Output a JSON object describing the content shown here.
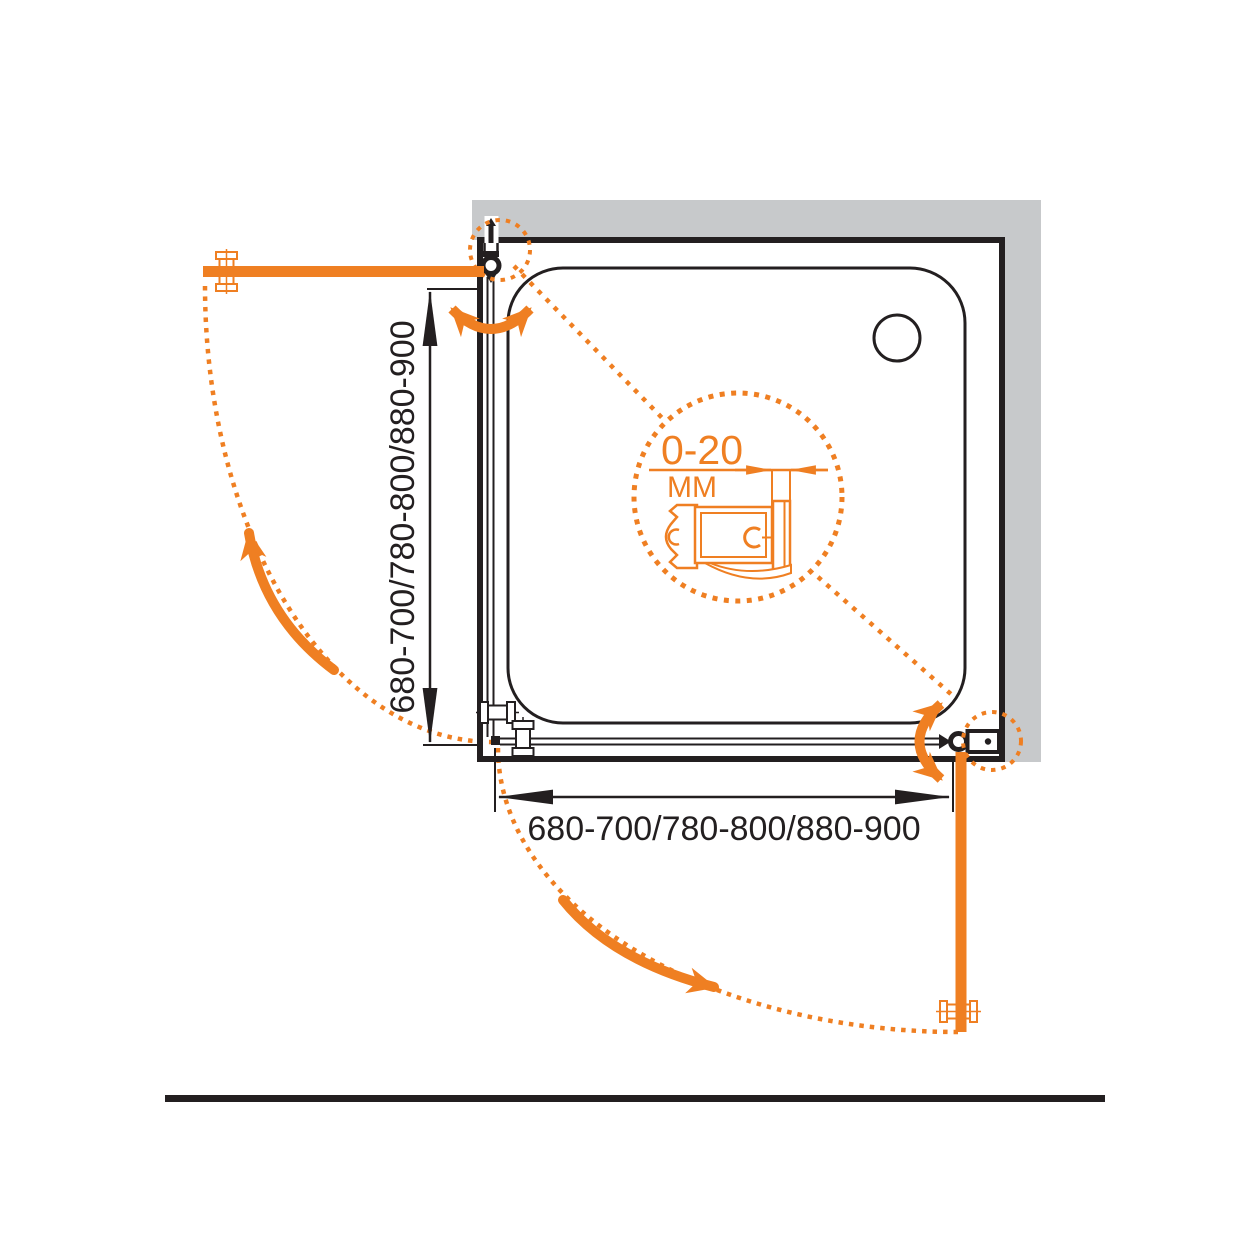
{
  "colors": {
    "accent": "#EF7F22",
    "wall_gray": "#C7C9CB",
    "ink": "#231F20",
    "background": "#FFFFFF"
  },
  "drawing": {
    "width_dimension_label": "680-700/780-800/880-900",
    "height_dimension_label": "680-700/780-800/880-900",
    "detail_callout": {
      "range_label": "0-20",
      "unit_label": "MM"
    }
  }
}
